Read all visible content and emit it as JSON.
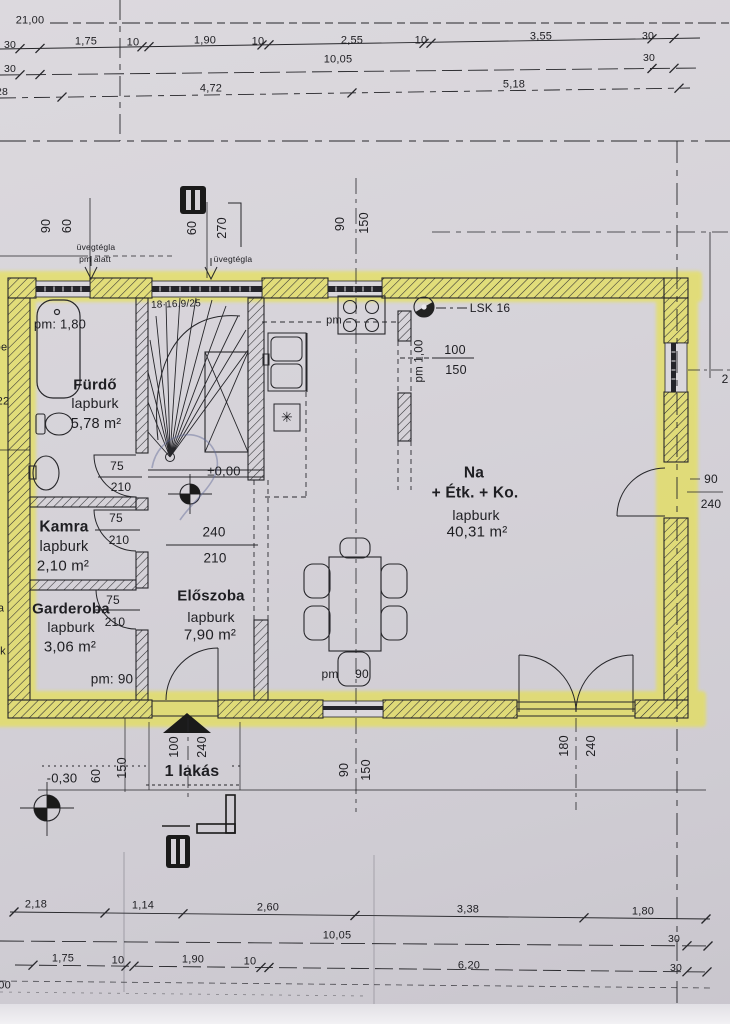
{
  "dims_top": {
    "total": "21,00",
    "r1": [
      "30",
      "1,75",
      "10",
      "1,90",
      "10",
      "2,55",
      "10",
      "3,55",
      "30"
    ],
    "r2": [
      "30",
      "10,05",
      "30"
    ],
    "r3": [
      "28",
      "4,72",
      "5,18"
    ]
  },
  "dims_bottom": {
    "r1": [
      "2,18",
      "1,14",
      "2,60",
      "3,38",
      "1,80"
    ],
    "r2": [
      "10,05",
      "30"
    ],
    "r3": [
      "1,75",
      "10",
      "1,90",
      "10",
      "6,20",
      "30"
    ],
    "partial": ",00"
  },
  "vdims": {
    "w1a": "90",
    "w1b": "60",
    "w2a": "60",
    "w2b": "270",
    "w3a": "90",
    "w3b": "150",
    "entry_w": "100",
    "entry_h": "240",
    "e150": "150",
    "e60": "60",
    "bw_a": "90",
    "bw_b": "150",
    "dd_a": "180",
    "dd_b": "240",
    "rd_a": "90",
    "rd_b": "240",
    "r_partial": "2"
  },
  "doors": {
    "d1": [
      "75",
      "210"
    ],
    "d2": [
      "75",
      "210"
    ],
    "d3": [
      "75",
      "210"
    ],
    "open": [
      "240",
      "210"
    ],
    "kwin": [
      "100",
      "150"
    ]
  },
  "rooms": {
    "furdo": {
      "pm": "pm: 1,80",
      "name": "Fürdő",
      "finish": "lapburk",
      "area": "5,78 m²"
    },
    "kamra": {
      "name": "Kamra",
      "finish": "lapburk",
      "area": "2,10 m²"
    },
    "garderoba": {
      "name": "Garderoba",
      "finish": "lapburk",
      "area": "3,06 m²",
      "pm": "pm: 90"
    },
    "eloszoba": {
      "name": "Előszoba",
      "finish": "lapburk",
      "area": "7,90 m²"
    },
    "nappali": {
      "l1": "Na",
      "l2": "+ Étk. + Ko.",
      "finish": "lapburk",
      "area": "40,31 m²"
    }
  },
  "labels": {
    "stair_spec": "18·16,9/25",
    "level_main": "±0,00",
    "level_entry": "-0,30",
    "glass1a": "üvegtégla",
    "glass1b": "pm alatt",
    "glass2": "üvegtégla",
    "vent": "LSK 16",
    "pm_kitchen": "pm",
    "pm_wall": "pm 1,00",
    "pm_table_a": "pm",
    "pm_table_b": "90",
    "unit": "1 lakás",
    "appliance": "✳",
    "m_oe": "oe",
    "m_22": "22",
    "m_a": "a",
    "m_k": "k"
  },
  "colors": {
    "highlighter": "#e9e33a",
    "ink": "#26262a",
    "paper": "#d5d2d8"
  }
}
